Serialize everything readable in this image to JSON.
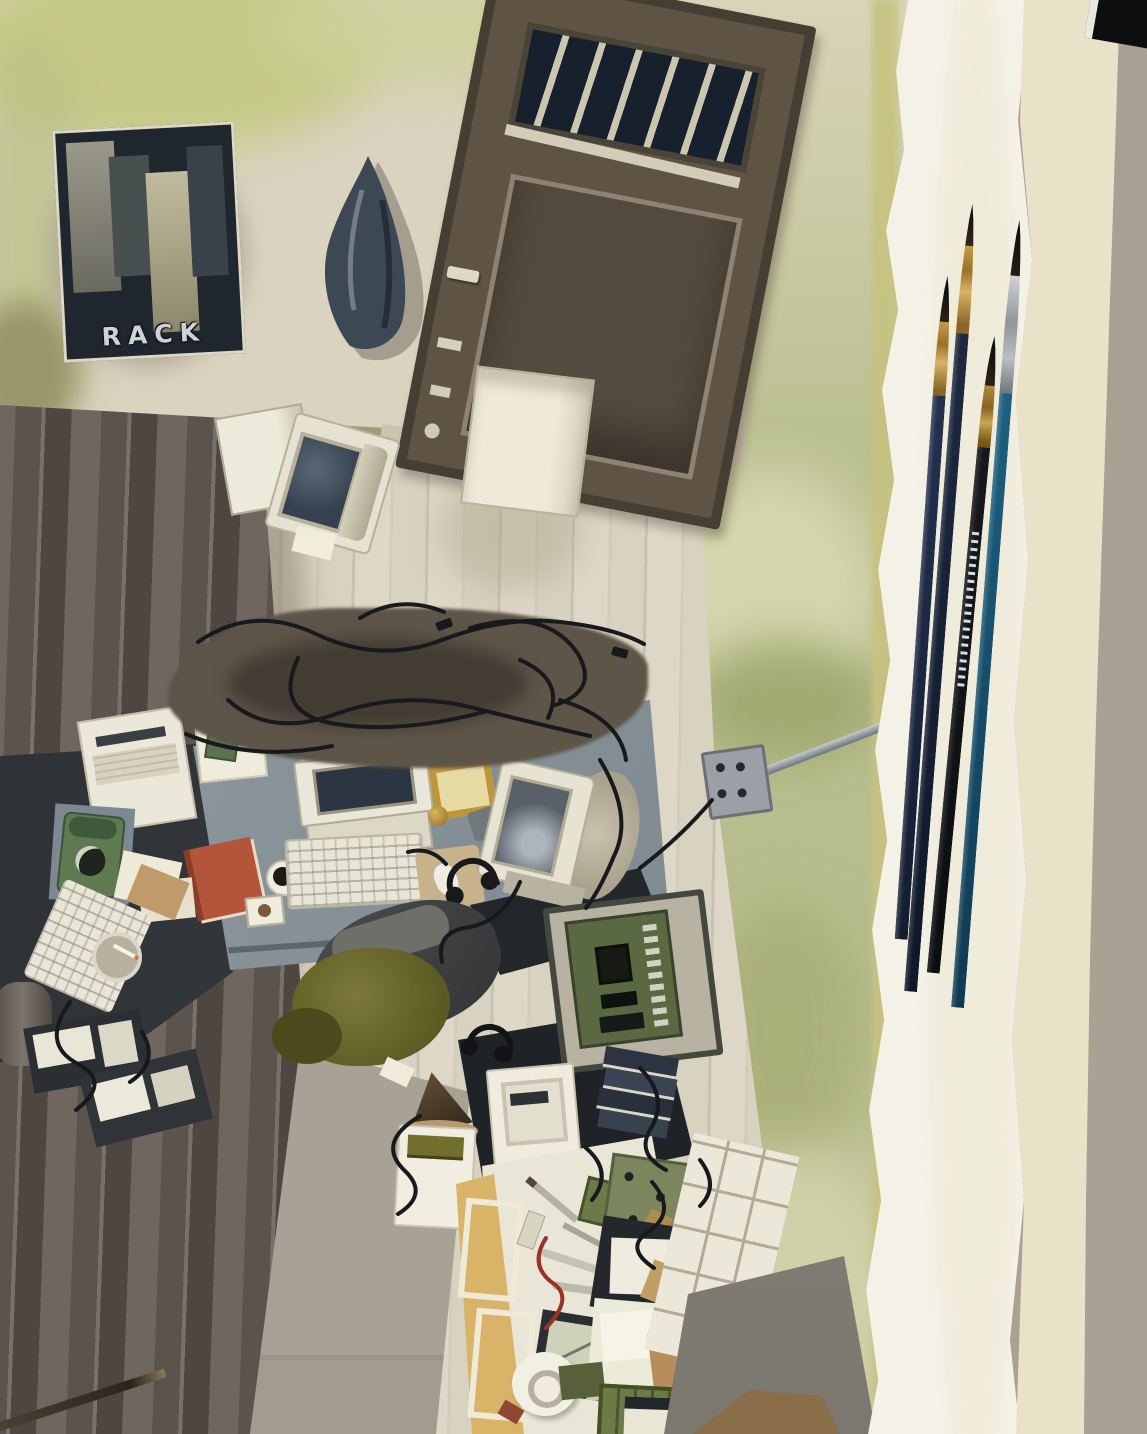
{
  "artwork": {
    "title_note": "photograph of a watercolor painting on a gray table",
    "poster_text": "RACK",
    "objects": [
      "city poster labeled RACK",
      "hanging dark jacket",
      "wooden door with barred window",
      "small CRT monitor on floor",
      "cardboard box",
      "tangle of black cables",
      "corner desk with two workstations",
      "beige CRT computer and split keyboard",
      "CRT monitor on its side",
      "green rotary telephone",
      "orange book",
      "white printer",
      "ashtray with cigarette",
      "coffee mug",
      "mouse pad and mouse",
      "gold picture frame",
      "headphones",
      "desk chair with olive jacket",
      "open PC case with green motherboard",
      "stack of dark books",
      "white computer tower",
      "wall outlet with conduit and cable",
      "workbench with tools",
      "roll of tape",
      "red wire",
      "storage boxes and green crates",
      "white tile patch",
      "wood plank flooring",
      "green watercolor wall washes",
      "four paintbrushes on paper margin",
      "pencil tip at bottom left",
      "torn watercolor paper edge",
      "gray table surface"
    ],
    "brushes": [
      {
        "handle": "#233150",
        "ferrule": "gold"
      },
      {
        "handle": "#1e2940",
        "ferrule": "gold"
      },
      {
        "handle": "#17181d",
        "ferrule": "gold",
        "detail": "barcode"
      },
      {
        "handle": "#1d6080",
        "ferrule": "silver"
      }
    ],
    "palette": {
      "paper": "#f4f1e6",
      "cream_band": "#e9e2c8",
      "table": "#aba296",
      "wall_green": "#b7bd8e",
      "wash_yellow_green": "#c3ca83",
      "floor_light": "#d9d3c2",
      "floor_dark": "#665e57",
      "door_brown": "#5f5346",
      "poster_dark": "#20262e",
      "desk_gray": "#8b959b",
      "desk_dark": "#2c3034",
      "olive_jacket": "#6f6c35",
      "book_orange": "#b3553a",
      "phone_green": "#5f7a50",
      "board_green": "#5a6941",
      "cable_black": "#17191d",
      "ferrule_gold": "#b48a3e",
      "brush_teal": "#1c5a78"
    }
  }
}
